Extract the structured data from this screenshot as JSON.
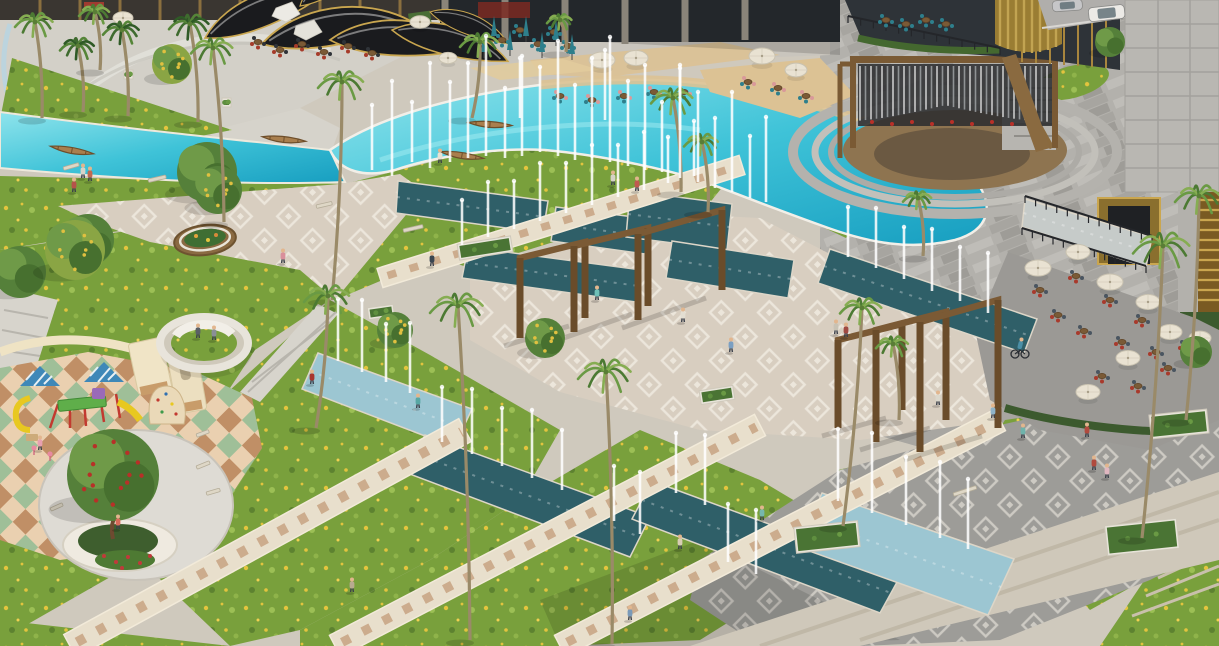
{
  "scene": {
    "description": "Aerial 3D architectural rendering of a landscaped plaza park with turquoise pool, fountain channels, palms, amphitheater, cafes and playground",
    "palette": {
      "pool_light": "#8fe4ec",
      "pool_mid": "#3fc3d8",
      "pool_deep": "#179ec0",
      "channel_dark": "#2f5f68",
      "channel_pale": "#9cc6d2",
      "promenade_water": "#c6cbc9",
      "lawn": "#79a03c",
      "lawn_light": "#9cbf55",
      "flower_yellow": "#e3c43e",
      "path_beige": "#e8dfcc",
      "paver_tan": "#caa787",
      "plaza_cream": "#d8cec0",
      "plaza_gray": "#9d9c98",
      "motif_white": "#f4f0e7",
      "granite": "#b3b1ac",
      "stone": "#b9b7b2",
      "wood": "#7b5a35",
      "gold": "#c9a64f",
      "canopy_dark": "#1a1b1e",
      "umbrella_cream": "#e9e2d2",
      "umbrella_teal": "#2e7f8c",
      "chair_red": "#a83a2c",
      "chair_slate": "#4a5560",
      "sand": "#dcc294",
      "checker_sage": "#9fbf98",
      "checker_cream": "#ead0b0",
      "checker_terra": "#c08f66",
      "roof_blue": "#3f88b8",
      "slide_yellow": "#e8c820",
      "post_red": "#c23a30"
    },
    "pool_jets": [
      [
        372,
        170,
        65
      ],
      [
        392,
        176,
        95
      ],
      [
        412,
        162,
        60
      ],
      [
        430,
        168,
        105
      ],
      [
        450,
        162,
        80
      ],
      [
        468,
        158,
        95
      ],
      [
        486,
        156,
        120
      ],
      [
        505,
        158,
        70
      ],
      [
        522,
        156,
        100
      ],
      [
        540,
        152,
        85
      ],
      [
        558,
        156,
        115
      ],
      [
        575,
        160,
        75
      ],
      [
        592,
        158,
        100
      ],
      [
        610,
        162,
        125
      ],
      [
        628,
        166,
        85
      ],
      [
        645,
        170,
        105
      ],
      [
        662,
        172,
        70
      ],
      [
        680,
        178,
        110
      ],
      [
        698,
        182,
        90
      ],
      [
        715,
        188,
        70
      ],
      [
        732,
        192,
        100
      ],
      [
        750,
        198,
        62
      ],
      [
        766,
        202,
        85
      ],
      [
        605,
        120,
        70
      ],
      [
        520,
        118,
        60
      ],
      [
        680,
        130,
        65
      ]
    ],
    "channels": [
      [
        "398,181 548,201 543,233 396,213",
        "d"
      ],
      [
        "556,207 650,219 645,254 551,241",
        "d"
      ],
      [
        "630,191 732,204 727,250 626,237",
        "d"
      ],
      [
        "468,247 642,270 636,302 462,278",
        "d"
      ],
      [
        "672,241 794,260 788,298 666,278",
        "d"
      ],
      [
        "830,249 1037,319 1024,353 818,283",
        "d"
      ],
      [
        "318,353 472,409 454,447 302,389",
        "p"
      ],
      [
        "425,435 650,517 630,557 407,473",
        "d"
      ],
      [
        "652,481 902,573 880,613 632,519",
        "d"
      ],
      [
        "822,493 1014,559 988,615 798,547",
        "p"
      ],
      [
        "1025,199 1152,237 1146,267 1022,227",
        "w"
      ]
    ],
    "channel_jets": [
      [
        462,
        245,
        45
      ],
      [
        488,
        237,
        55
      ],
      [
        514,
        229,
        48
      ],
      [
        540,
        221,
        58
      ],
      [
        566,
        213,
        50
      ],
      [
        592,
        205,
        60
      ],
      [
        618,
        197,
        52
      ],
      [
        644,
        190,
        58
      ],
      [
        668,
        183,
        46
      ],
      [
        694,
        176,
        55
      ],
      [
        848,
        257,
        50
      ],
      [
        876,
        268,
        60
      ],
      [
        904,
        279,
        52
      ],
      [
        932,
        291,
        62
      ],
      [
        960,
        301,
        54
      ],
      [
        988,
        313,
        60
      ],
      [
        338,
        361,
        62
      ],
      [
        362,
        372,
        72
      ],
      [
        386,
        382,
        58
      ],
      [
        410,
        393,
        70
      ],
      [
        442,
        442,
        55
      ],
      [
        472,
        454,
        65
      ],
      [
        502,
        466,
        58
      ],
      [
        532,
        478,
        68
      ],
      [
        562,
        490,
        60
      ],
      [
        614,
        521,
        55
      ],
      [
        640,
        534,
        62
      ],
      [
        676,
        493,
        60
      ],
      [
        705,
        505,
        70
      ],
      [
        838,
        501,
        72
      ],
      [
        872,
        513,
        80
      ],
      [
        906,
        525,
        68
      ],
      [
        940,
        538,
        76
      ],
      [
        968,
        549,
        70
      ],
      [
        728,
        562,
        58
      ],
      [
        756,
        574,
        64
      ]
    ],
    "walkways": [
      [
        70,
        646,
        465,
        430,
        26
      ],
      [
        335,
        646,
        760,
        425,
        24
      ],
      [
        560,
        646,
        1000,
        420,
        24
      ],
      [
        380,
        278,
        742,
        165,
        20
      ]
    ],
    "pergolas": {
      "groups": [
        [
          [
            520,
            338,
            258,
            585,
            318,
            242
          ],
          [
            574,
            332,
            246,
            648,
            306,
            228
          ],
          [
            638,
            320,
            234,
            722,
            290,
            210
          ]
        ],
        [
          [
            838,
            428,
            340,
            902,
            410,
            324
          ],
          [
            876,
            442,
            330,
            946,
            420,
            312
          ],
          [
            920,
            452,
            322,
            998,
            428,
            300
          ]
        ]
      ]
    },
    "palms": [
      [
        35,
        22,
        20,
        42,
        118,
        "f"
      ],
      [
        78,
        46,
        18,
        83,
        112,
        "p"
      ],
      [
        122,
        30,
        19,
        128,
        116,
        "p"
      ],
      [
        190,
        24,
        21,
        198,
        122,
        "p"
      ],
      [
        213,
        48,
        22,
        224,
        222,
        "f"
      ],
      [
        342,
        82,
        24,
        332,
        300,
        "f"
      ],
      [
        480,
        42,
        20,
        472,
        118,
        "f"
      ],
      [
        560,
        20,
        13,
        566,
        52,
        "f"
      ],
      [
        673,
        98,
        22,
        681,
        192,
        "f"
      ],
      [
        702,
        142,
        18,
        708,
        212,
        "f"
      ],
      [
        918,
        198,
        15,
        923,
        256,
        "f"
      ],
      [
        328,
        296,
        24,
        316,
        428,
        "f"
      ],
      [
        458,
        306,
        28,
        470,
        640,
        "f"
      ],
      [
        606,
        372,
        28,
        612,
        644,
        "f"
      ],
      [
        862,
        308,
        22,
        843,
        526,
        "f"
      ],
      [
        893,
        344,
        17,
        899,
        420,
        "f"
      ],
      [
        1163,
        246,
        30,
        1142,
        538,
        "f"
      ],
      [
        1199,
        196,
        24,
        1186,
        420,
        "f"
      ],
      [
        95,
        12,
        16,
        100,
        70,
        "f"
      ]
    ],
    "trees": [
      [
        207,
        172,
        30,
        "g"
      ],
      [
        88,
        240,
        26,
        "g"
      ],
      [
        218,
        190,
        24,
        "yg"
      ],
      [
        20,
        272,
        26,
        "g"
      ],
      [
        395,
        330,
        18,
        "yg"
      ],
      [
        545,
        338,
        20,
        "yg"
      ],
      [
        172,
        64,
        20,
        "ys"
      ],
      [
        75,
        250,
        30,
        "ys"
      ],
      [
        1110,
        42,
        15,
        "g"
      ],
      [
        113,
        475,
        46,
        "rt"
      ],
      [
        1196,
        352,
        16,
        "g"
      ]
    ],
    "people": [
      [
        74,
        192,
        "#b5524a"
      ],
      [
        83,
        178,
        "#d8d3c8"
      ],
      [
        90,
        181,
        "#c06a52"
      ],
      [
        283,
        263,
        "#d98f9b"
      ],
      [
        432,
        266,
        "#3a4550"
      ],
      [
        312,
        384,
        "#a8352f"
      ],
      [
        418,
        408,
        "#58a7a4"
      ],
      [
        597,
        300,
        "#6fc0b8"
      ],
      [
        637,
        191,
        "#c05a50"
      ],
      [
        613,
        185,
        "#d6d2c6"
      ],
      [
        683,
        322,
        "#e3ded2"
      ],
      [
        731,
        352,
        "#7b9fc2"
      ],
      [
        836,
        334,
        "#c8c2b4"
      ],
      [
        846,
        337,
        "#a04a42"
      ],
      [
        938,
        405,
        "#dcd8cc"
      ],
      [
        993,
        418,
        "#8fb3c8"
      ],
      [
        680,
        549,
        "#d8cdb4"
      ],
      [
        762,
        520,
        "#76b7ae"
      ],
      [
        1023,
        438,
        "#6fb3ab"
      ],
      [
        1087,
        437,
        "#b04a3e"
      ],
      [
        1094,
        470,
        "#b04a3e"
      ],
      [
        1107,
        478,
        "#e0b7c0"
      ],
      [
        440,
        163,
        "#e8e2d4"
      ],
      [
        352,
        592,
        "#b8aa90"
      ],
      [
        630,
        620,
        "#7a9ab8"
      ],
      [
        118,
        529,
        "#d86a5a"
      ],
      [
        40,
        450,
        "#e8a0b0"
      ],
      [
        198,
        338,
        "#5a5f66"
      ],
      [
        214,
        340,
        "#8a8f96"
      ]
    ],
    "cyclist": {
      "x": 1020,
      "y": 352,
      "shirt": "#4b8fa6"
    },
    "boats": [
      [
        72,
        150,
        10
      ],
      [
        284,
        139,
        6
      ],
      [
        490,
        124,
        4
      ],
      [
        462,
        155,
        9
      ]
    ],
    "cars": [
      [
        1088,
        8,
        36,
        14,
        "#eceae6",
        -6
      ],
      [
        1052,
        1,
        30,
        11,
        "#c6c6c8",
        -4
      ]
    ],
    "umbrellas_round": [
      [
        602,
        60,
        13
      ],
      [
        636,
        58,
        12
      ],
      [
        762,
        56,
        13
      ],
      [
        796,
        70,
        11
      ],
      [
        420,
        22,
        10
      ],
      [
        123,
        18,
        10
      ],
      [
        448,
        58,
        9
      ],
      [
        1038,
        268,
        13
      ],
      [
        1078,
        252,
        12
      ],
      [
        1110,
        282,
        13
      ],
      [
        1148,
        302,
        12
      ],
      [
        1170,
        332,
        12
      ],
      [
        1200,
        338,
        11
      ],
      [
        1128,
        358,
        12
      ],
      [
        1088,
        392,
        12
      ]
    ],
    "umbrellas_folded": [
      [
        494,
        24
      ],
      [
        510,
        38
      ],
      [
        526,
        24
      ],
      [
        542,
        40
      ],
      [
        556,
        28
      ],
      [
        572,
        42
      ],
      [
        484,
        40
      ]
    ],
    "table_styles": [
      [
        "#a63b2a",
        "#2f3338"
      ],
      [
        "#2e7f8c",
        "#d9999a"
      ],
      [
        "#a83a2c",
        "#4a5560"
      ],
      [
        "#2e7f8c",
        "#2e7f8c"
      ]
    ],
    "tables": [
      [
        258,
        42,
        0
      ],
      [
        280,
        50,
        0
      ],
      [
        302,
        44,
        0
      ],
      [
        324,
        52,
        0
      ],
      [
        348,
        46,
        0
      ],
      [
        372,
        53,
        0
      ],
      [
        560,
        96,
        1
      ],
      [
        592,
        100,
        1
      ],
      [
        624,
        96,
        1
      ],
      [
        654,
        92,
        1
      ],
      [
        684,
        92,
        1
      ],
      [
        748,
        82,
        1
      ],
      [
        778,
        88,
        1
      ],
      [
        806,
        96,
        1
      ],
      [
        1040,
        290,
        2
      ],
      [
        1076,
        276,
        2
      ],
      [
        1110,
        300,
        2
      ],
      [
        1142,
        320,
        2
      ],
      [
        1122,
        342,
        2
      ],
      [
        1084,
        331,
        2
      ],
      [
        1058,
        315,
        2
      ],
      [
        1156,
        352,
        2
      ],
      [
        1186,
        346,
        2
      ],
      [
        1102,
        376,
        2
      ],
      [
        1138,
        386,
        2
      ],
      [
        1168,
        368,
        2
      ],
      [
        502,
        40,
        3
      ],
      [
        520,
        30,
        3
      ],
      [
        538,
        44,
        3
      ],
      [
        554,
        32,
        3
      ],
      [
        568,
        46,
        3
      ],
      [
        886,
        20,
        3
      ],
      [
        906,
        24,
        3
      ],
      [
        926,
        20,
        3
      ],
      [
        946,
        24,
        3
      ]
    ],
    "benches": [
      [
        403,
        229,
        20,
        -13
      ],
      [
        63,
        167,
        16,
        -16
      ],
      [
        148,
        179,
        18,
        -13
      ],
      [
        316,
        205,
        16,
        -13
      ],
      [
        953,
        493,
        24,
        -18
      ],
      [
        196,
        466,
        14,
        -22
      ],
      [
        206,
        492,
        14,
        -16
      ],
      [
        50,
        508,
        13,
        -24
      ],
      [
        196,
        434,
        13,
        -20
      ]
    ],
    "planters": [
      [
        458,
        240,
        54,
        16,
        -9
      ],
      [
        368,
        306,
        26,
        12,
        -8
      ],
      [
        795,
        524,
        64,
        26,
        -6
      ],
      [
        1106,
        522,
        72,
        30,
        -6
      ],
      [
        1150,
        412,
        58,
        24,
        -6
      ],
      [
        700,
        388,
        34,
        14,
        -9
      ],
      [
        124,
        70,
        9,
        9,
        0
      ],
      [
        222,
        98,
        9,
        9,
        0
      ]
    ],
    "railings": [
      [
        1025,
        196,
        1152,
        236
      ],
      [
        1022,
        228,
        1146,
        266
      ],
      [
        848,
        16,
        1000,
        48
      ]
    ],
    "rod_screen": {
      "x1": 860,
      "x2": 1050,
      "y_top": 66,
      "max_len": 56
    }
  }
}
